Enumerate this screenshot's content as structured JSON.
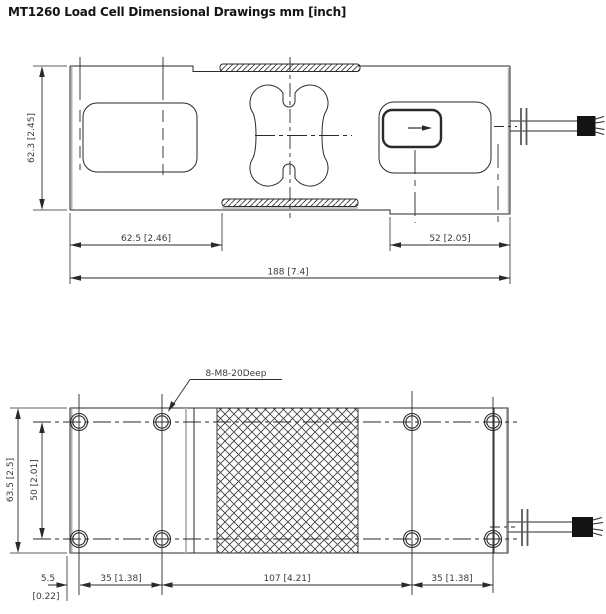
{
  "title": "MT1260 Load Cell Dimensional Drawings mm [inch]",
  "style": {
    "line_color": "#2a2a2a",
    "gray_edge_color": "#b3b3b3",
    "text_color": "#3a3a3a",
    "cable_end_color": "#141414"
  },
  "side_view": {
    "dim_height": "62.3 [2.45]",
    "dim_left_section": "62.5 [2.46]",
    "dim_right_section": "52 [2.05]",
    "dim_overall": "188 [7.4]"
  },
  "plan_view": {
    "dim_width": "63.5 [2.5]",
    "dim_hole_rows": "50 [2.01]",
    "dim_edge_mm": "5.5",
    "dim_edge_in": "[0.22]",
    "dim_pitch_left": "35 [1.38]",
    "dim_pitch_mid": "107 [4.21]",
    "dim_pitch_right": "35 [1.38]",
    "thread_callout": "8-M8-20Deep"
  }
}
